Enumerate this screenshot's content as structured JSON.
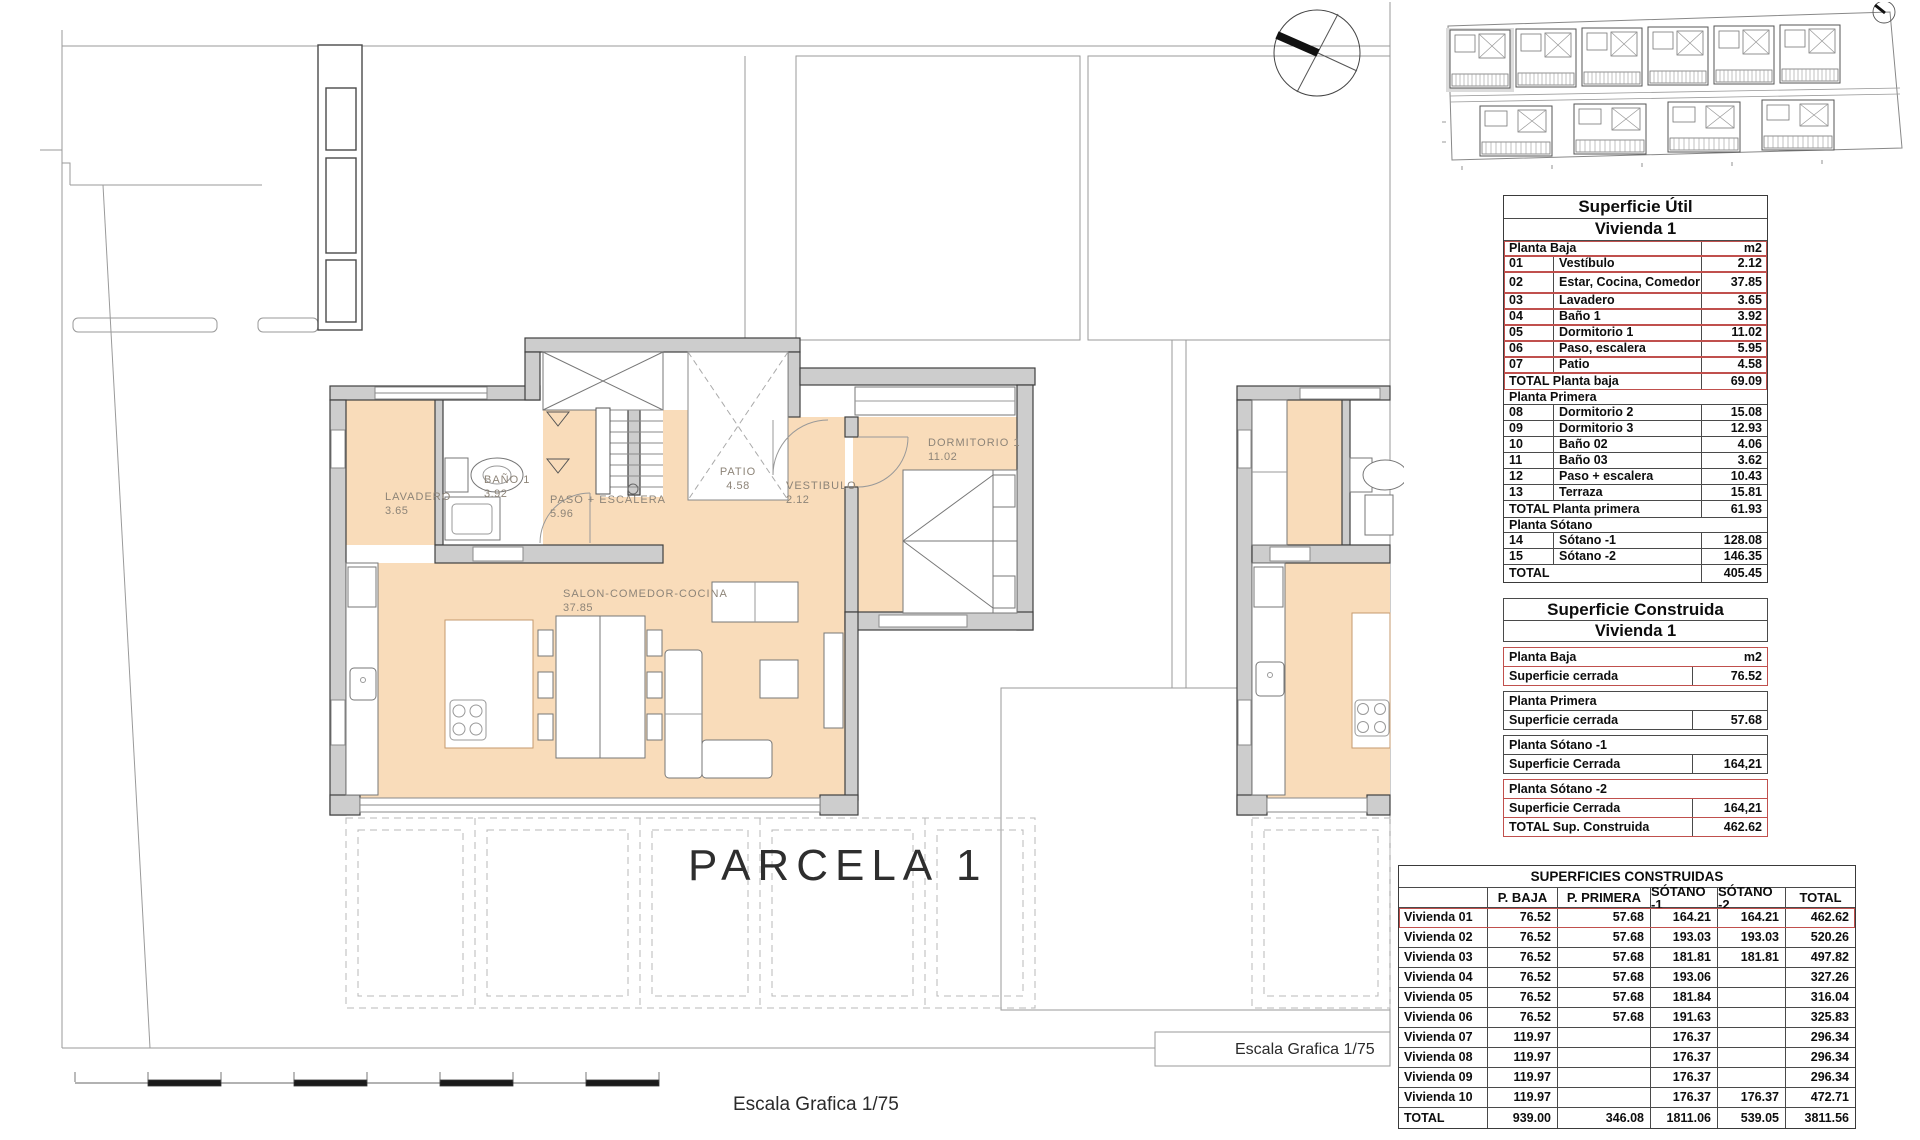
{
  "plan": {
    "parcel_label": "PARCELA 1",
    "scale_label_bottom": "Escala Grafica 1/75",
    "scale_label_right": "Escala Grafica 1/75",
    "labels": {
      "lavadero": {
        "name": "LAVADERO",
        "value": "3.65"
      },
      "bano": {
        "name": "BAÑO 1",
        "value": "3.92"
      },
      "paso": {
        "name": "PASO + ESCALERA",
        "value": "5.96"
      },
      "patio": {
        "name": "PATIO",
        "value": "4.58"
      },
      "vestibulo": {
        "name": "VESTIBULO",
        "value": "2.12"
      },
      "dormitorio": {
        "name": "DORMITORIO 1",
        "value": "11.02"
      },
      "salon": {
        "name": "SALON-COMEDOR-COCINA",
        "value": "37.85"
      }
    }
  },
  "colors": {
    "floor_fill": "#f9dcba",
    "wall_fill": "#cdcdcd",
    "accent_red": "#c0504d",
    "line_gray": "#9a9a9a",
    "site_highlight": "#dcdcdc"
  },
  "tables": {
    "superficie_util": {
      "title": "Superficie Útil",
      "subtitle": "Vivienda 1",
      "rows": [
        {
          "type": "head",
          "label": "Planta Baja",
          "value": "m2",
          "red": true
        },
        {
          "type": "item",
          "num": "01",
          "label": "Vestíbulo",
          "value": "2.12",
          "red": true
        },
        {
          "type": "item",
          "num": "02",
          "label": "Estar, Cocina, Comedor",
          "value": "37.85",
          "red": true,
          "tall": true
        },
        {
          "type": "item",
          "num": "03",
          "label": "Lavadero",
          "value": "3.65",
          "red": true
        },
        {
          "type": "item",
          "num": "04",
          "label": "Baño 1",
          "value": "3.92",
          "red": true
        },
        {
          "type": "item",
          "num": "05",
          "label": "Dormitorio 1",
          "value": "11.02",
          "red": true
        },
        {
          "type": "item",
          "num": "06",
          "label": "Paso, escalera",
          "value": "5.95",
          "red": true
        },
        {
          "type": "item",
          "num": "07",
          "label": "Patio",
          "value": "4.58",
          "red": true
        },
        {
          "type": "total",
          "label": "TOTAL Planta baja",
          "value": "69.09",
          "red": true
        },
        {
          "type": "sect",
          "label": "Planta Primera"
        },
        {
          "type": "item",
          "num": "08",
          "label": "Dormitorio 2",
          "value": "15.08"
        },
        {
          "type": "item",
          "num": "09",
          "label": "Dormitorio 3",
          "value": "12.93"
        },
        {
          "type": "item",
          "num": "10",
          "label": "Baño 02",
          "value": "4.06"
        },
        {
          "type": "item",
          "num": "11",
          "label": "Baño 03",
          "value": "3.62"
        },
        {
          "type": "item",
          "num": "12",
          "label": "Paso + escalera",
          "value": "10.43"
        },
        {
          "type": "item",
          "num": "13",
          "label": "Terraza",
          "value": "15.81"
        },
        {
          "type": "total",
          "label": "TOTAL Planta primera",
          "value": "61.93"
        },
        {
          "type": "sect",
          "label": "Planta Sótano"
        },
        {
          "type": "item",
          "num": "14",
          "label": "Sótano -1",
          "value": "128.08"
        },
        {
          "type": "item",
          "num": "15",
          "label": "Sótano -2",
          "value": "146.35"
        },
        {
          "type": "total",
          "label": "TOTAL",
          "value": "405.45"
        }
      ]
    },
    "superficie_construida": {
      "title": "Superficie Construida",
      "subtitle": "Vivienda 1",
      "rows": [
        {
          "type": "sect",
          "label": "Planta Baja",
          "value": "m2",
          "red": true,
          "gap": true
        },
        {
          "type": "val",
          "label": "Superficie cerrada",
          "value": "76.52",
          "red": true
        },
        {
          "type": "sect",
          "label": "Planta Primera",
          "gap": true
        },
        {
          "type": "val",
          "label": "Superficie cerrada",
          "value": "57.68"
        },
        {
          "type": "sect",
          "label": "Planta Sótano -1",
          "gap": true
        },
        {
          "type": "val",
          "label": "Superficie Cerrada",
          "value": "164,21"
        },
        {
          "type": "sect",
          "label": "Planta Sótano -2",
          "red": true,
          "gap": true
        },
        {
          "type": "val",
          "label": "Superficie Cerrada",
          "value": "164,21",
          "red": true
        },
        {
          "type": "val",
          "label": "TOTAL Sup. Construida",
          "value": "462.62",
          "red": true
        }
      ]
    },
    "superficies_construidas": {
      "title": "SUPERFICIES CONSTRUIDAS",
      "columns": [
        "",
        "P. BAJA",
        "P. PRIMERA",
        "SÓTANO -1",
        "SÓTANO -2",
        "TOTAL"
      ],
      "rows": [
        {
          "label": "Vivienda 01",
          "values": [
            "76.52",
            "57.68",
            "164.21",
            "164.21",
            "462.62"
          ],
          "red": true
        },
        {
          "label": "Vivienda 02",
          "values": [
            "76.52",
            "57.68",
            "193.03",
            "193.03",
            "520.26"
          ]
        },
        {
          "label": "Vivienda 03",
          "values": [
            "76.52",
            "57.68",
            "181.81",
            "181.81",
            "497.82"
          ]
        },
        {
          "label": "Vivienda 04",
          "values": [
            "76.52",
            "57.68",
            "193.06",
            "",
            "327.26"
          ]
        },
        {
          "label": "Vivienda 05",
          "values": [
            "76.52",
            "57.68",
            "181.84",
            "",
            "316.04"
          ]
        },
        {
          "label": "Vivienda 06",
          "values": [
            "76.52",
            "57.68",
            "191.63",
            "",
            "325.83"
          ]
        },
        {
          "label": "Vivienda 07",
          "values": [
            "119.97",
            "",
            "176.37",
            "",
            "296.34"
          ]
        },
        {
          "label": "Vivienda 08",
          "values": [
            "119.97",
            "",
            "176.37",
            "",
            "296.34"
          ]
        },
        {
          "label": "Vivienda 09",
          "values": [
            "119.97",
            "",
            "176.37",
            "",
            "296.34"
          ]
        },
        {
          "label": "Vivienda 10",
          "values": [
            "119.97",
            "",
            "176.37",
            "176.37",
            "472.71"
          ]
        },
        {
          "label": "TOTAL",
          "values": [
            "939.00",
            "346.08",
            "1811.06",
            "539.05",
            "3811.56"
          ]
        }
      ]
    }
  }
}
